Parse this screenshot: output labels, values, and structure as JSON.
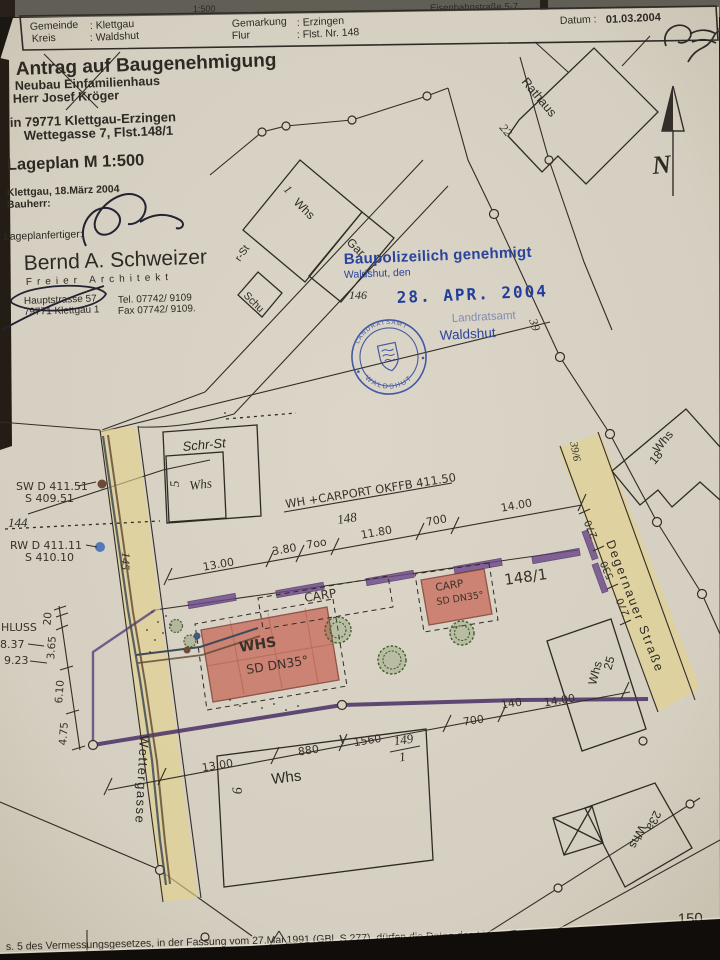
{
  "top_strip": {
    "left_fragment": "1:500",
    "right_fragment": "Eisenbahnstraße 5-7"
  },
  "header": {
    "gemeinde_label": "Gemeinde",
    "gemeinde_value": ": Klettgau",
    "kreis_label": "Kreis",
    "kreis_value": ": Waldshut",
    "gemarkung_label": "Gemarkung",
    "gemarkung_value": ": Erzingen",
    "flur_label": "Flur",
    "flur_value": ": Flst. Nr. 148",
    "datum_label": "Datum :",
    "datum_value": "01.03.2004"
  },
  "title_block": {
    "title": "Antrag auf Baugenehmigung",
    "project": "Neubau Einfamilienhaus",
    "client": "Herr Josef Kröger",
    "location1": "in 79771 Klettgau-Erzingen",
    "location2": "Wettegasse 7, Flst.148/1",
    "plan_scale": "Lageplan M 1:500",
    "place_date": "Klettgau, 18.März 2004",
    "bauherr_label": "Bauherr:",
    "preparer_label": "Lageplanfertiger:",
    "architect_name": "Bernd A. Schweizer",
    "architect_title": "Freier Architekt",
    "address_line1": "Hauptstrasse 57",
    "address_line2": "79771 Klettgau 1",
    "tel": "Tel. 07742/ 9109",
    "fax": "Fax 07742/ 9109."
  },
  "approval_stamp": {
    "line1": "Baupolizeilich genehmigt",
    "line2": "Waldshut, den",
    "date": "28. APR. 2004",
    "office_top": "Landratsamt",
    "office_bottom": "Waldshut",
    "seal_arc_top": "LANDRATSAMT",
    "seal_arc_bottom": "WALDSHUT"
  },
  "north_label": "N",
  "streets": {
    "wettergasse": "Wettergasse",
    "degernauer": "Degernauer Straße",
    "rathaus": "Rathaus",
    "partial": "r-St"
  },
  "parcels": {
    "p144": "144",
    "p145": "145",
    "p146": "146",
    "p148": "148",
    "p148_1": "148/1",
    "p149_num": "149",
    "p149_den": "1",
    "p150": "150",
    "p39": "39",
    "p39_6": "39/6",
    "p22": "22"
  },
  "buildings": {
    "b1_no": "1",
    "b1_type": "Whs",
    "b1_gar": "Gar",
    "schu": "Schu",
    "schr_st": "Schr-St",
    "b5_no": "5",
    "b5_type": "Whs",
    "whs_main": "WHS",
    "whs_main_roof": "SD DN35°",
    "carp_dashed": "CARP",
    "carp2": "CARP",
    "carp2_roof": "SD DN35°",
    "b6_no": "6",
    "b6_type": "Whs",
    "b25_no": "25",
    "b25_type": "Whs",
    "b23a_no": "23a",
    "b23a_type": "Whs",
    "b18_no": "18",
    "b18_type": "Whs"
  },
  "annotations": {
    "ridge": "WH +CARPORT OKFFB 411.50",
    "sw1": "SW D 411.51",
    "sw2": "S 409.51",
    "rw1": "RW D 411.11",
    "rw2": "S 410.10",
    "anschluss": "HLUSS",
    "ans1": "8.37",
    "ans2": "9.23"
  },
  "dims": {
    "top": [
      "13.00",
      "3.80",
      "7oo",
      "11.80",
      "700",
      "14.00"
    ],
    "left": [
      "20",
      "3.65",
      "6.10",
      "4.75"
    ],
    "bottom": [
      "13.00",
      "880",
      "1560"
    ],
    "bottom_right": [
      "700",
      "140",
      "14.00"
    ],
    "right": [
      "270",
      "530",
      "270"
    ]
  },
  "footer": "s. 5 des Vermessungsgesetzes, in der Fassung vom 27.Mai 1991 (GBl. S.277), dürfen die Daten des Liegen"
}
